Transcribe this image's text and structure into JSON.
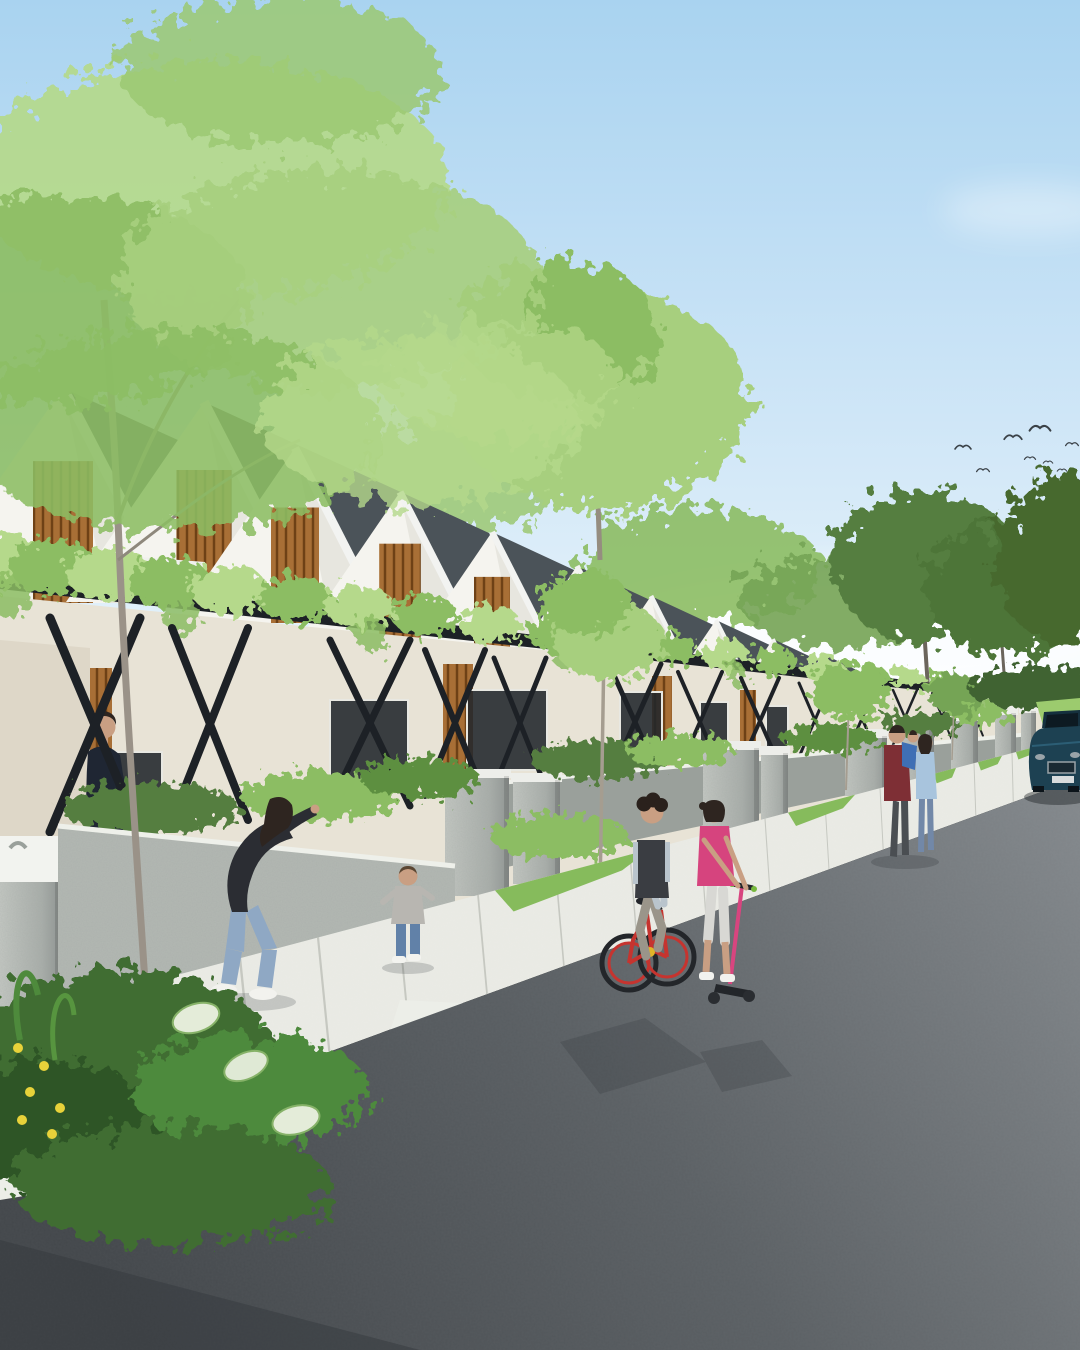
{
  "meta": {
    "description": "Architectural rendering of a modern tropical row-house street: white gable houses with dark shingle roofs and wood-slat gables, a continuous vine-covered pergola with black X braces, concrete gate pillars, families on the sidewalk, kids on a bicycle and scooter, a parked dark-blue sedan, birds in a light blue sky",
    "type": "architectural-render",
    "visible_text": ""
  },
  "palette": {
    "sky_top": "#a9d3f0",
    "sky_mid": "#cfe6f7",
    "sky_horizon": "#eef7fc",
    "cloud": "#ffffff",
    "foliage_light": "#b5d98b",
    "foliage_mid": "#8cbd63",
    "foliage_dark": "#557e3f",
    "foliage_deep": "#46692f",
    "trunk": "#9a9288",
    "roof": "#4b5359",
    "roof_shadow": "#3e464c",
    "ridge": "#f2f3f1",
    "wall_white": "#f5f4ef",
    "wall_cream": "#e8e3d6",
    "wall_shadow": "#d6d5cd",
    "wood": "#a86f36",
    "wood_dark": "#6e4116",
    "pergola": "#1d2126",
    "concrete": "#a9aeaa",
    "concrete_light": "#c6c9c4",
    "concrete_cap": "#edeeea",
    "garden_wall": "#9aa09b",
    "near_wall": "#b3b8b3",
    "grass": "#86bb5c",
    "grass_light": "#9ccb6e",
    "sidewalk": "#e9eae4",
    "sidewalk_joint": "#c6c8c1",
    "road_light": "#82878b",
    "road_mid": "#5b6064",
    "road_dark": "#43474b",
    "shadow": "#2f3337",
    "skin": "#c99f83",
    "hair": "#2e2520"
  },
  "objects": {
    "man": {
      "shirt": "#1f2633",
      "shorts": "#cfc4a6",
      "shoes": "#f0f0ec"
    },
    "woman": {
      "top": "#2b2d33",
      "jeans": "#8fa8c4",
      "shoes": "#f2f2ee"
    },
    "toddler": {
      "top": "#b8b6b1",
      "jeans": "#6181a8",
      "shoes": "#f3f3ef",
      "hair": "#5a4632"
    },
    "boy": {
      "tee": "#b9c4cc",
      "vest": "#3a3d42",
      "pants": "#9a958a",
      "bike_frame": "#c6342f",
      "bike_accent": "#e0b429",
      "tire": "#23262a"
    },
    "girl": {
      "top": "#d6447e",
      "pants": "#d8d8d4",
      "scooter_stem": "#d8457f",
      "scooter_deck": "#23262a",
      "grip_accent": "#77b83d"
    },
    "father": {
      "shirt": "#7e2f35",
      "pants": "#4a4e52"
    },
    "carried_child": {
      "outfit": "#3f6fb5"
    },
    "mother": {
      "top": "#a8c4dd",
      "jeans": "#7288a8"
    },
    "car": {
      "body": "#1d4152",
      "roof": "#15303e",
      "glass": "#0d1a22",
      "grille": "#1a2a33",
      "trim": "#9aa3a8",
      "plate": "#d8dcdd"
    }
  },
  "scene": {
    "birds": {
      "color": "#3a4147",
      "flock": [
        [
          963,
          447,
          1
        ],
        [
          983,
          470,
          0.8
        ],
        [
          1013,
          437,
          1.1
        ],
        [
          1040,
          428,
          1.3
        ],
        [
          1030,
          458,
          0.7
        ],
        [
          1048,
          462,
          0.6
        ],
        [
          1062,
          470,
          0.6
        ],
        [
          1072,
          444,
          0.8
        ],
        [
          1076,
          480,
          0.5
        ]
      ]
    },
    "houses": [
      [
        63,
        388,
        150,
        215,
        1
      ],
      [
        204,
        402,
        138,
        200,
        1
      ],
      [
        295,
        448,
        120,
        175,
        1
      ],
      [
        400,
        492,
        104,
        152,
        1
      ],
      [
        492,
        532,
        90,
        132,
        1
      ],
      [
        577,
        566,
        78,
        115,
        1
      ],
      [
        651,
        596,
        68,
        100,
        0
      ],
      [
        716,
        620,
        59,
        87,
        0
      ],
      [
        773,
        639,
        51,
        76,
        0
      ],
      [
        823,
        654,
        44,
        66,
        0
      ],
      [
        866,
        666,
        38,
        57,
        0
      ],
      [
        903,
        676,
        33,
        49,
        0
      ],
      [
        934,
        684,
        28,
        42,
        0
      ],
      [
        960,
        690,
        24,
        36,
        0
      ],
      [
        982,
        695,
        21,
        31,
        0
      ],
      [
        1000,
        699,
        18,
        27,
        0
      ]
    ],
    "canopy": {
      "x1": 0,
      "y1": 572,
      "x2": 1045,
      "y2": 700
    },
    "vine_clumps": [
      [
        0,
        46
      ],
      [
        55,
        44
      ],
      [
        110,
        43
      ],
      [
        170,
        41
      ],
      [
        230,
        39
      ],
      [
        295,
        37
      ],
      [
        360,
        35
      ],
      [
        425,
        33
      ],
      [
        490,
        31
      ],
      [
        555,
        29
      ],
      [
        615,
        27
      ],
      [
        672,
        25
      ],
      [
        725,
        24
      ],
      [
        775,
        22
      ],
      [
        822,
        21
      ],
      [
        866,
        19
      ],
      [
        906,
        18
      ],
      [
        942,
        17
      ],
      [
        975,
        16
      ],
      [
        1005,
        15
      ],
      [
        1032,
        14
      ]
    ],
    "braces": [
      [
        95,
        45,
        618,
        832,
        9
      ],
      [
        210,
        38,
        628,
        820,
        8
      ],
      [
        370,
        40,
        640,
        806,
        7
      ],
      [
        455,
        30,
        650,
        796,
        6
      ],
      [
        520,
        26,
        658,
        788,
        5
      ],
      [
        635,
        26,
        664,
        780,
        5
      ],
      [
        700,
        22,
        672,
        772,
        4
      ],
      [
        760,
        19,
        678,
        764,
        4
      ],
      [
        815,
        16,
        683,
        757,
        3
      ],
      [
        862,
        14,
        687,
        750,
        3
      ],
      [
        905,
        12,
        690,
        745,
        2.5
      ],
      [
        942,
        10,
        693,
        740,
        2
      ],
      [
        975,
        8,
        696,
        736,
        2
      ],
      [
        1005,
        7,
        698,
        733,
        1.5
      ]
    ],
    "pillars": [
      [
        0,
        852,
        60,
        200
      ],
      [
        445,
        776,
        64,
        120
      ],
      [
        513,
        780,
        47,
        104
      ],
      [
        703,
        748,
        56,
        80
      ],
      [
        761,
        753,
        27,
        74
      ],
      [
        845,
        736,
        42,
        60
      ],
      [
        901,
        727,
        33,
        53
      ],
      [
        951,
        719,
        27,
        50
      ],
      [
        995,
        713,
        21,
        44
      ],
      [
        1021,
        711,
        15,
        40
      ]
    ],
    "windows": [
      [
        108,
        752,
        54,
        60
      ],
      [
        330,
        700,
        78,
        88
      ],
      [
        467,
        690,
        80,
        80
      ],
      [
        620,
        692,
        42,
        66
      ],
      [
        700,
        702,
        28,
        52
      ],
      [
        766,
        706,
        22,
        42
      ]
    ],
    "slat_panels": [
      [
        20,
        668,
        92,
        172
      ],
      [
        443,
        664,
        30,
        124
      ],
      [
        652,
        676,
        20,
        96
      ],
      [
        740,
        690,
        16,
        70
      ]
    ],
    "sidewalk": {
      "top": [
        0,
        1022,
        1046,
        744
      ],
      "curb": [
        0,
        1172,
        1052,
        788
      ],
      "joints": [
        30,
        95,
        165,
        240,
        318,
        398,
        478,
        556,
        630,
        700,
        765,
        825,
        880,
        930,
        974,
        1012,
        1044
      ]
    },
    "grass_wedges": [
      [
        495,
        650
      ],
      [
        788,
        855
      ],
      [
        886,
        908
      ],
      [
        934,
        956
      ],
      [
        978,
        1002
      ],
      [
        1016,
        1036
      ]
    ],
    "shrubs": [
      [
        150,
        808,
        90,
        26
      ],
      [
        320,
        796,
        80,
        24
      ],
      [
        420,
        778,
        60,
        20
      ],
      [
        600,
        760,
        70,
        20
      ],
      [
        680,
        750,
        55,
        16
      ],
      [
        830,
        738,
        50,
        14
      ],
      [
        920,
        724,
        40,
        12
      ],
      [
        560,
        836,
        70,
        22
      ],
      [
        760,
        856,
        55,
        18
      ],
      [
        300,
        988,
        70,
        24
      ],
      [
        980,
        714,
        30,
        10
      ]
    ],
    "flowers": {
      "yellow": [
        [
          18,
          1048
        ],
        [
          44,
          1066
        ],
        [
          30,
          1092
        ],
        [
          60,
          1108
        ],
        [
          22,
          1120
        ],
        [
          52,
          1134
        ]
      ],
      "pink": [
        [
          298,
          984
        ],
        [
          316,
          994
        ],
        [
          286,
          1000
        ],
        [
          306,
          1004
        ],
        [
          762,
          854
        ],
        [
          778,
          862
        ],
        [
          752,
          862
        ],
        [
          960,
          778
        ]
      ]
    }
  }
}
